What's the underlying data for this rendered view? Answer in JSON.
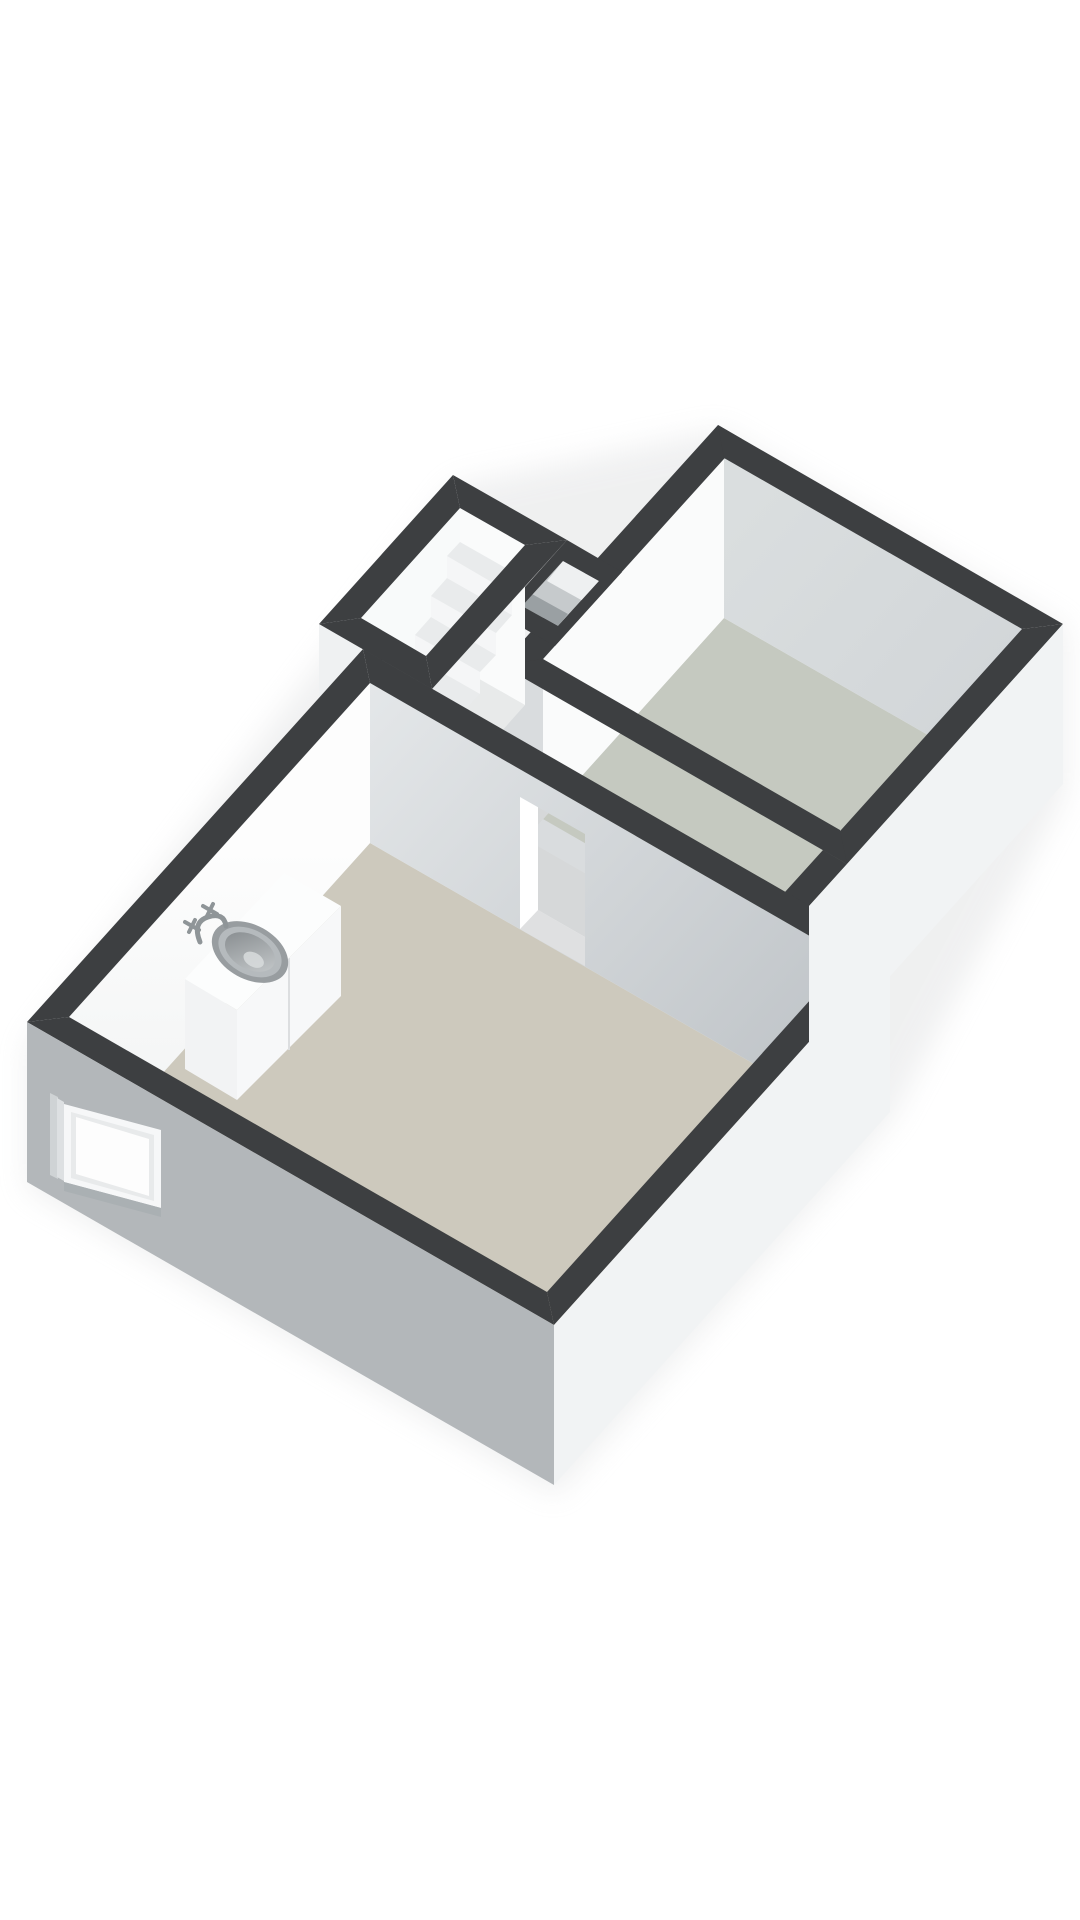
{
  "scene": {
    "type": "3d-floorplan-render",
    "rooms": [
      {
        "name": "main-room",
        "floor_color_key": "floor_main"
      },
      {
        "name": "storage-room",
        "floor_color_key": "floor_storage"
      },
      {
        "name": "staircase-room",
        "floor_color_key": "stair_floor"
      },
      {
        "name": "corridor",
        "floor_color_key": "floor_corridor"
      },
      {
        "name": "duct-shaft",
        "floor_color_key": "duct_mid"
      }
    ],
    "objects": [
      "sink-cabinet",
      "sink-basin",
      "faucet",
      "window",
      "stairs",
      "door-opening"
    ]
  },
  "colors": {
    "background": "#ffffff",
    "cap": "#3d3f41",
    "floor_main": "#cdc9bd",
    "floor_storage": "#c5c9c0",
    "floor_corridor": "#d6d8d9",
    "threshold": "#dfe0e1",
    "wall_white": "#fafbfb",
    "wall_white_soft": "#f4f6f6",
    "int_grad_start": "#e4e7e9",
    "int_grad_end": "#bcc1c5",
    "storage_int_gray": "#d0d4d7",
    "ext_gray": "#b3b7ba",
    "ext_white": "#f1f3f4",
    "ext_light": "#e9ebed",
    "ext_mid": "#d9dcde",
    "ext_sliver": "#eff1f2",
    "stair_floor": "#e8eaea",
    "step_top": "#e9ebec",
    "step_riser": "#f5f6f7",
    "duct_mid": "#c6cacc",
    "duct_light": "#eef0f1",
    "duct_dark": "#9aa0a3",
    "window_frame": "#f6f7f8",
    "window_inner": "#e8eaeb",
    "window_glass": "#fdfdfd",
    "window_sill": "#aab0b3",
    "cabinet_top": "#fcfdfd",
    "cabinet_front": "#f2f3f4",
    "cabinet_side": "#f7f8f9",
    "cabinet_seam": "#dcdee0",
    "sink_outer": "#989da0",
    "sink_mid": "#b5babd",
    "bowl_start": "#83888b",
    "bowl_end": "#c9cdcf",
    "sink_hi": "#d8dcdd",
    "faucet": "#8f9598",
    "shadow": "#c9cbcd"
  }
}
